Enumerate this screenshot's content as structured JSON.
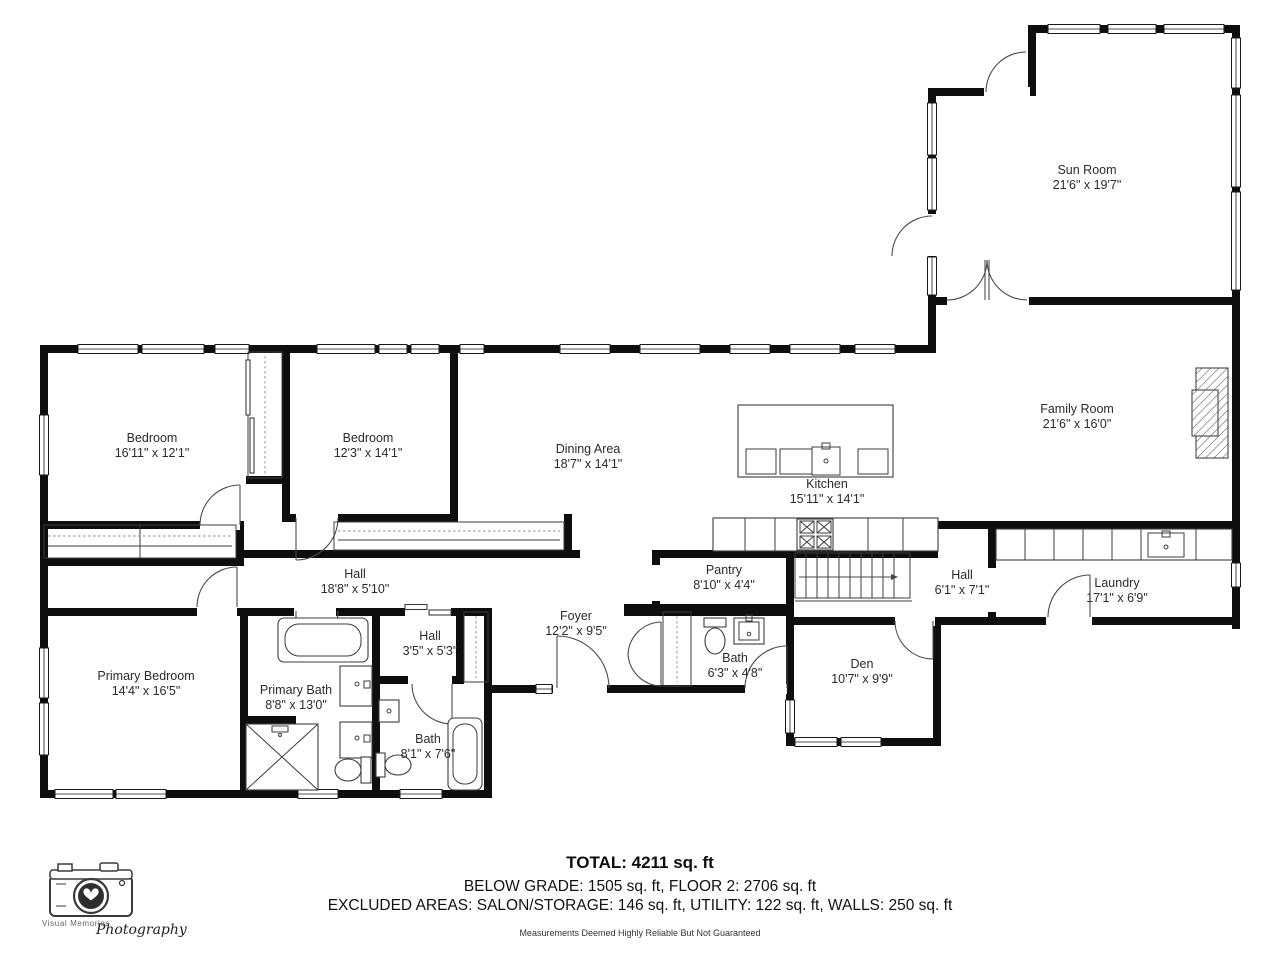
{
  "rooms": [
    {
      "name": "Sun Room",
      "dims": "21'6\" x 19'7\""
    },
    {
      "name": "Family Room",
      "dims": "21'6\" x 16'0\""
    },
    {
      "name": "Bedroom",
      "dims": "16'11\" x 12'1\""
    },
    {
      "name": "Bedroom",
      "dims": "12'3\" x 14'1\""
    },
    {
      "name": "Dining Area",
      "dims": "18'7\" x 14'1\""
    },
    {
      "name": "Kitchen",
      "dims": "15'11\" x 14'1\""
    },
    {
      "name": "Hall",
      "dims": "18'8\" x 5'10\""
    },
    {
      "name": "Pantry",
      "dims": "8'10\" x 4'4\""
    },
    {
      "name": "Hall",
      "dims": "6'1\" x 7'1\""
    },
    {
      "name": "Laundry",
      "dims": "17'1\" x 6'9\""
    },
    {
      "name": "Foyer",
      "dims": "12'2\" x 9'5\""
    },
    {
      "name": "Bath",
      "dims": "6'3\" x 4'8\""
    },
    {
      "name": "Den",
      "dims": "10'7\" x 9'9\""
    },
    {
      "name": "Primary Bedroom",
      "dims": "14'4\" x 16'5\""
    },
    {
      "name": "Primary Bath",
      "dims": "8'8\" x 13'0\""
    },
    {
      "name": "Hall",
      "dims": "3'5\" x 5'3\""
    },
    {
      "name": "Bath",
      "dims": "8'1\" x 7'6\""
    }
  ],
  "summary": {
    "total": "TOTAL: 4211 sq. ft",
    "line2": "BELOW GRADE: 1505 sq. ft, FLOOR 2: 2706 sq. ft",
    "line3": "EXCLUDED AREAS: SALON/STORAGE: 146 sq. ft, UTILITY: 122 sq. ft, WALLS: 250 sq. ft",
    "disclaimer": "Measurements Deemed Highly Reliable But Not Guaranteed"
  },
  "logo": {
    "brand": "Visual Memories",
    "script": "Photography"
  },
  "colors": {
    "wall": "#0e0e0e",
    "background": "#ffffff",
    "fixture_line": "#3c3c3c",
    "label_text": "#2b2b2b"
  }
}
